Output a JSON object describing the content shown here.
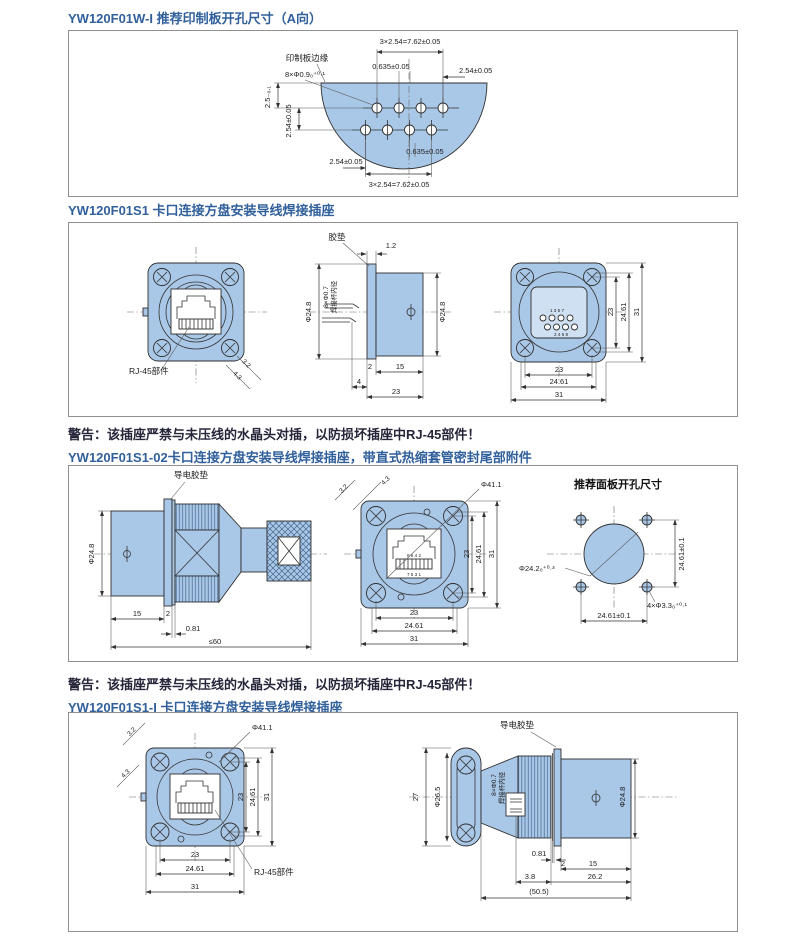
{
  "colors": {
    "drawing_fill": "#a9c7e7",
    "line": "#333333",
    "title_text": "#31609b",
    "warning_text": "#26263a",
    "panel_border": "#8f8f8f"
  },
  "headings": {
    "h1": "YW120F01W-I 推荐印制板开孔尺寸（A向）",
    "h2": "YW120F01S1 卡口连接方盘安装导线焊接插座",
    "warning1": "警告：该插座严禁与未压线的水晶头对插，以防损坏插座中RJ-45部件！",
    "h3": "YW120F01S1-02卡口连接方盘安装导线焊接插座，带直式热缩套管密封尾部附件",
    "warning2": "警告：该插座严禁与未压线的水晶头对插，以防损坏插座中RJ-45部件！",
    "h4": "YW120F01S1-I 卡口连接方盘安装导线焊接插座"
  },
  "panel1": {
    "dim_pitch_top": "3×2.54=7.62±0.05",
    "label_pcb_edge": "印制板边缘",
    "dim_0635_top": "0.635±0.05",
    "dim_254_top": "2.54±0.05",
    "dim_holes": "8×Φ0.9₀⁺⁰·¹",
    "dim_25_left": "2.5₋₀.₁",
    "dim_254_left": "2.54±0.05",
    "dim_254_bottom": "2.54±0.05",
    "dim_0635_bottom": "0.635±0.05",
    "dim_pitch_bottom": "3×2.54=7.62±0.05"
  },
  "panel2": {
    "front": {
      "label_rj45": "RJ-45部件",
      "diag_a": "3.2",
      "diag_b": "4.3"
    },
    "side": {
      "label_gasket": "胶垫",
      "dim_12": "1.2",
      "dim_d248_left": "Φ24.8",
      "dim_8x07": "8×Φ0.7",
      "label_cup": "焊接杯内径",
      "dim_d248_right": "Φ24.8",
      "dim_2": "2",
      "dim_15": "15",
      "dim_4": "4",
      "dim_23": "23"
    },
    "rear": {
      "pins_top": "1 3 5 7",
      "pins_bottom": "2 4 6 8",
      "dim_v23": "23",
      "dim_v2461": "24.61",
      "dim_v31": "31",
      "dim_h23": "23",
      "dim_h2461": "24.61",
      "dim_h31": "31"
    }
  },
  "panel3": {
    "side": {
      "label_gasket": "导电胶垫",
      "dim_d248": "Φ24.8",
      "dim_15": "15",
      "dim_2": "2",
      "dim_081": "0.81",
      "dim_le60": "≤60"
    },
    "front": {
      "dim_d411": "Φ41.1",
      "diag_a": "3.2",
      "diag_b": "4.3",
      "pins_top": "8 6 4 2",
      "pins_bottom": "7 5 3 1",
      "dim_v23": "23",
      "dim_v2461": "24.61",
      "dim_v31": "31",
      "dim_h23": "23",
      "dim_h2461": "24.61",
      "dim_h31": "31"
    },
    "cutout": {
      "title": "推荐面板开孔尺寸",
      "dim_d242": "Φ24.2₀⁺⁰·³",
      "dim_v2461": "24.61±0.1",
      "dim_holes": "4×Φ3.3₀⁺⁰·¹",
      "dim_h2461": "24.61±0.1"
    }
  },
  "panel4": {
    "front": {
      "dim_d411": "Φ41.1",
      "diag_a": "3.2",
      "diag_b": "4.3",
      "dim_v23": "23",
      "dim_v2461": "24.61",
      "dim_v31": "31",
      "dim_h23": "23",
      "dim_h2461": "24.61",
      "dim_h31": "31",
      "label_rj45": "RJ-45部件"
    },
    "side": {
      "label_gasket": "导电胶垫",
      "dim_27": "27",
      "dim_d265": "Φ26.5",
      "dim_8x07": "8×Φ0.7",
      "label_cup": "焊接杯内径",
      "dim_d248": "Φ24.8",
      "dim_081": "0.81",
      "dim_2": "2",
      "dim_15": "15",
      "dim_38": "3.8",
      "dim_262": "26.2",
      "dim_505": "(50.5)"
    }
  }
}
